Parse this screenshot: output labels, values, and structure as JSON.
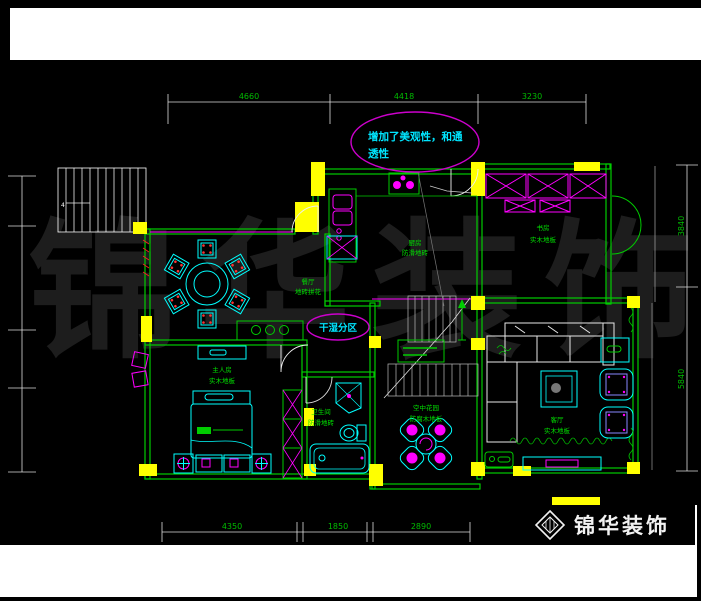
{
  "annotation_note": {
    "line1": "增加了美观性，和通",
    "line2": "透性"
  },
  "zone_label": "干湿分区",
  "dimensions": {
    "top": [
      "4660",
      "4418",
      "3230"
    ],
    "bottom": [
      "4350",
      "1850",
      "2890"
    ],
    "right": [
      "3840",
      "5840"
    ]
  },
  "rooms": {
    "dining": {
      "name": "餐厅",
      "floor": "地砖拼花"
    },
    "kitchen": {
      "name": "厨房",
      "floor": "防滑地砖"
    },
    "study": {
      "name": "书房",
      "floor": "实木地板"
    },
    "master": {
      "name": "主人房",
      "floor": "实木地板"
    },
    "bath": {
      "name": "卫生间",
      "floor": "防滑地砖"
    },
    "garden": {
      "name": "空中花园",
      "floor": "防腐木地板"
    },
    "living": {
      "name": "客厅",
      "floor": "实木地板"
    }
  },
  "stairs": {
    "flight_label": "4"
  },
  "watermark": "锦华装饰",
  "logo": {
    "brand": "锦华装饰"
  },
  "colors": {
    "wall_green": "#00cc00",
    "furniture_cyan": "#00ffff",
    "accent_magenta": "#ff00ff",
    "column_yellow": "#ffff00",
    "dim_text_green": "#00bb00",
    "note_cyan": "#00e5ff",
    "background": "#000000",
    "white_lines": "#ffffff"
  }
}
